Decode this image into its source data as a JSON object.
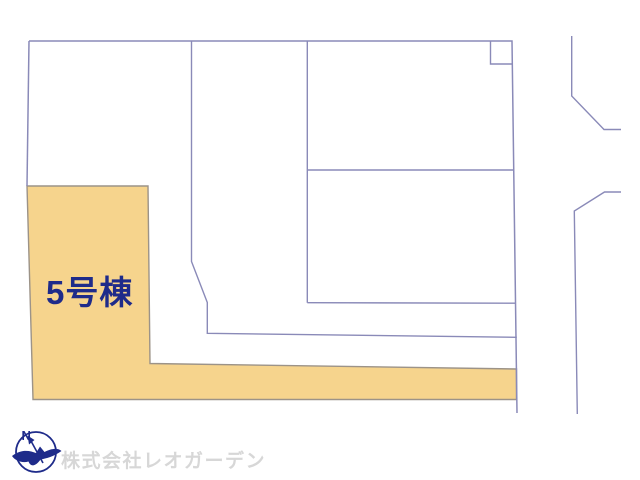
{
  "plan": {
    "lot_label": "5号棟",
    "compass_north_label": "N"
  },
  "footer": {
    "company_watermark": "株式会社レオガーデン"
  },
  "colors": {
    "boundary_line": "#8a8ab8",
    "lot5_fill": "#f6d48d",
    "lot5_stroke": "#9c9388",
    "label_navy": "#1e2b8a",
    "compass_navy": "#1e2b8a",
    "watermark_gray": "#d7d7d7"
  }
}
